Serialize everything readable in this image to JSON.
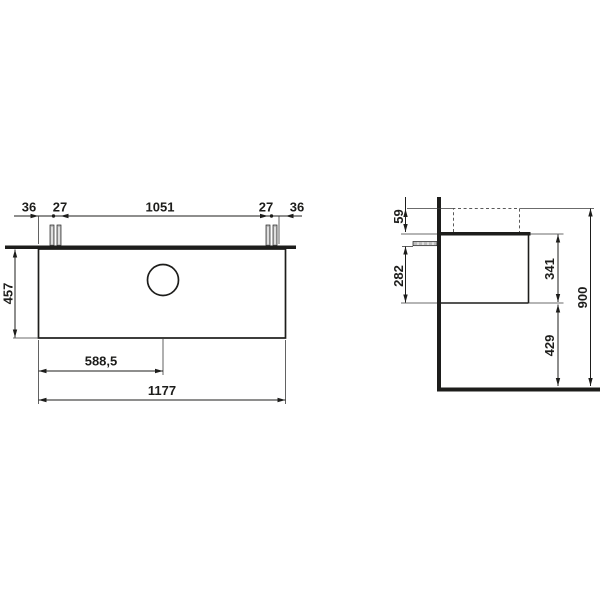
{
  "drawing": {
    "background_color": "#ffffff",
    "line_color": "#1d1d1b",
    "front_view": {
      "dims": {
        "edge_to_screws_left": "36",
        "screw_pair_left": "27",
        "screws_span": "1051",
        "screw_pair_right": "27",
        "edge_to_screws_right": "36",
        "front_height": "457",
        "drain_center_offset": "588,5",
        "total_width": "1177"
      }
    },
    "side_view": {
      "dims": {
        "rim_above_top": "59",
        "bracket_below_top": "282",
        "body_height": "341",
        "clearance_to_floor": "429",
        "overall_height": "900"
      }
    }
  }
}
